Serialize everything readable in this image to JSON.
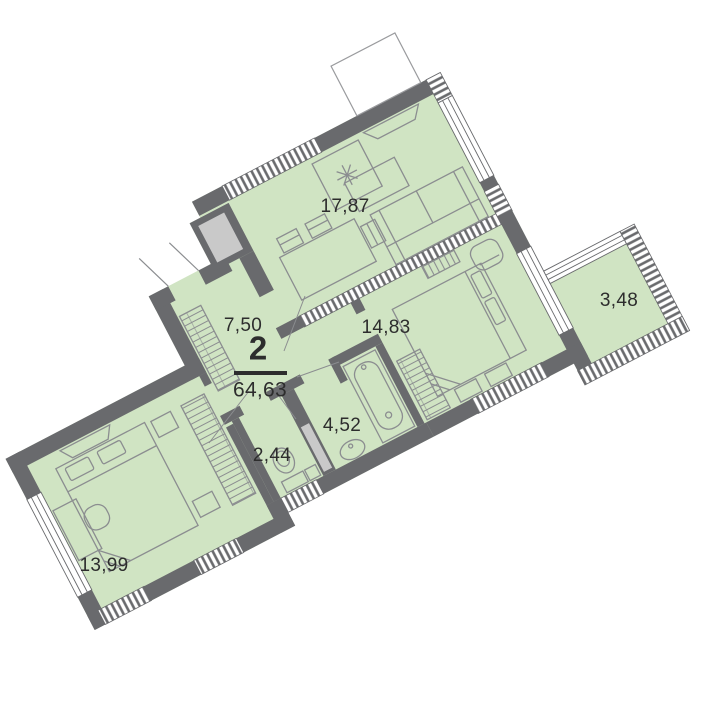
{
  "plan": {
    "apartment": {
      "rooms_label": "2",
      "total_area": "64,63"
    },
    "rooms": [
      {
        "name": "living-room",
        "area": "17,87"
      },
      {
        "name": "hallway",
        "area": "7,50"
      },
      {
        "name": "bedroom-right",
        "area": "14,83"
      },
      {
        "name": "loggia",
        "area": "3,48"
      },
      {
        "name": "bathroom",
        "area": "4,52"
      },
      {
        "name": "wc",
        "area": "2,44"
      },
      {
        "name": "bedroom-left",
        "area": "13,99"
      }
    ]
  },
  "colors": {
    "floor": "#d0e4c3",
    "walls": "#696a6d",
    "shaft": "#c9c9c9",
    "furniture_lines": "#8b8d90",
    "text": "#2d2d2d",
    "background": "#ffffff"
  }
}
